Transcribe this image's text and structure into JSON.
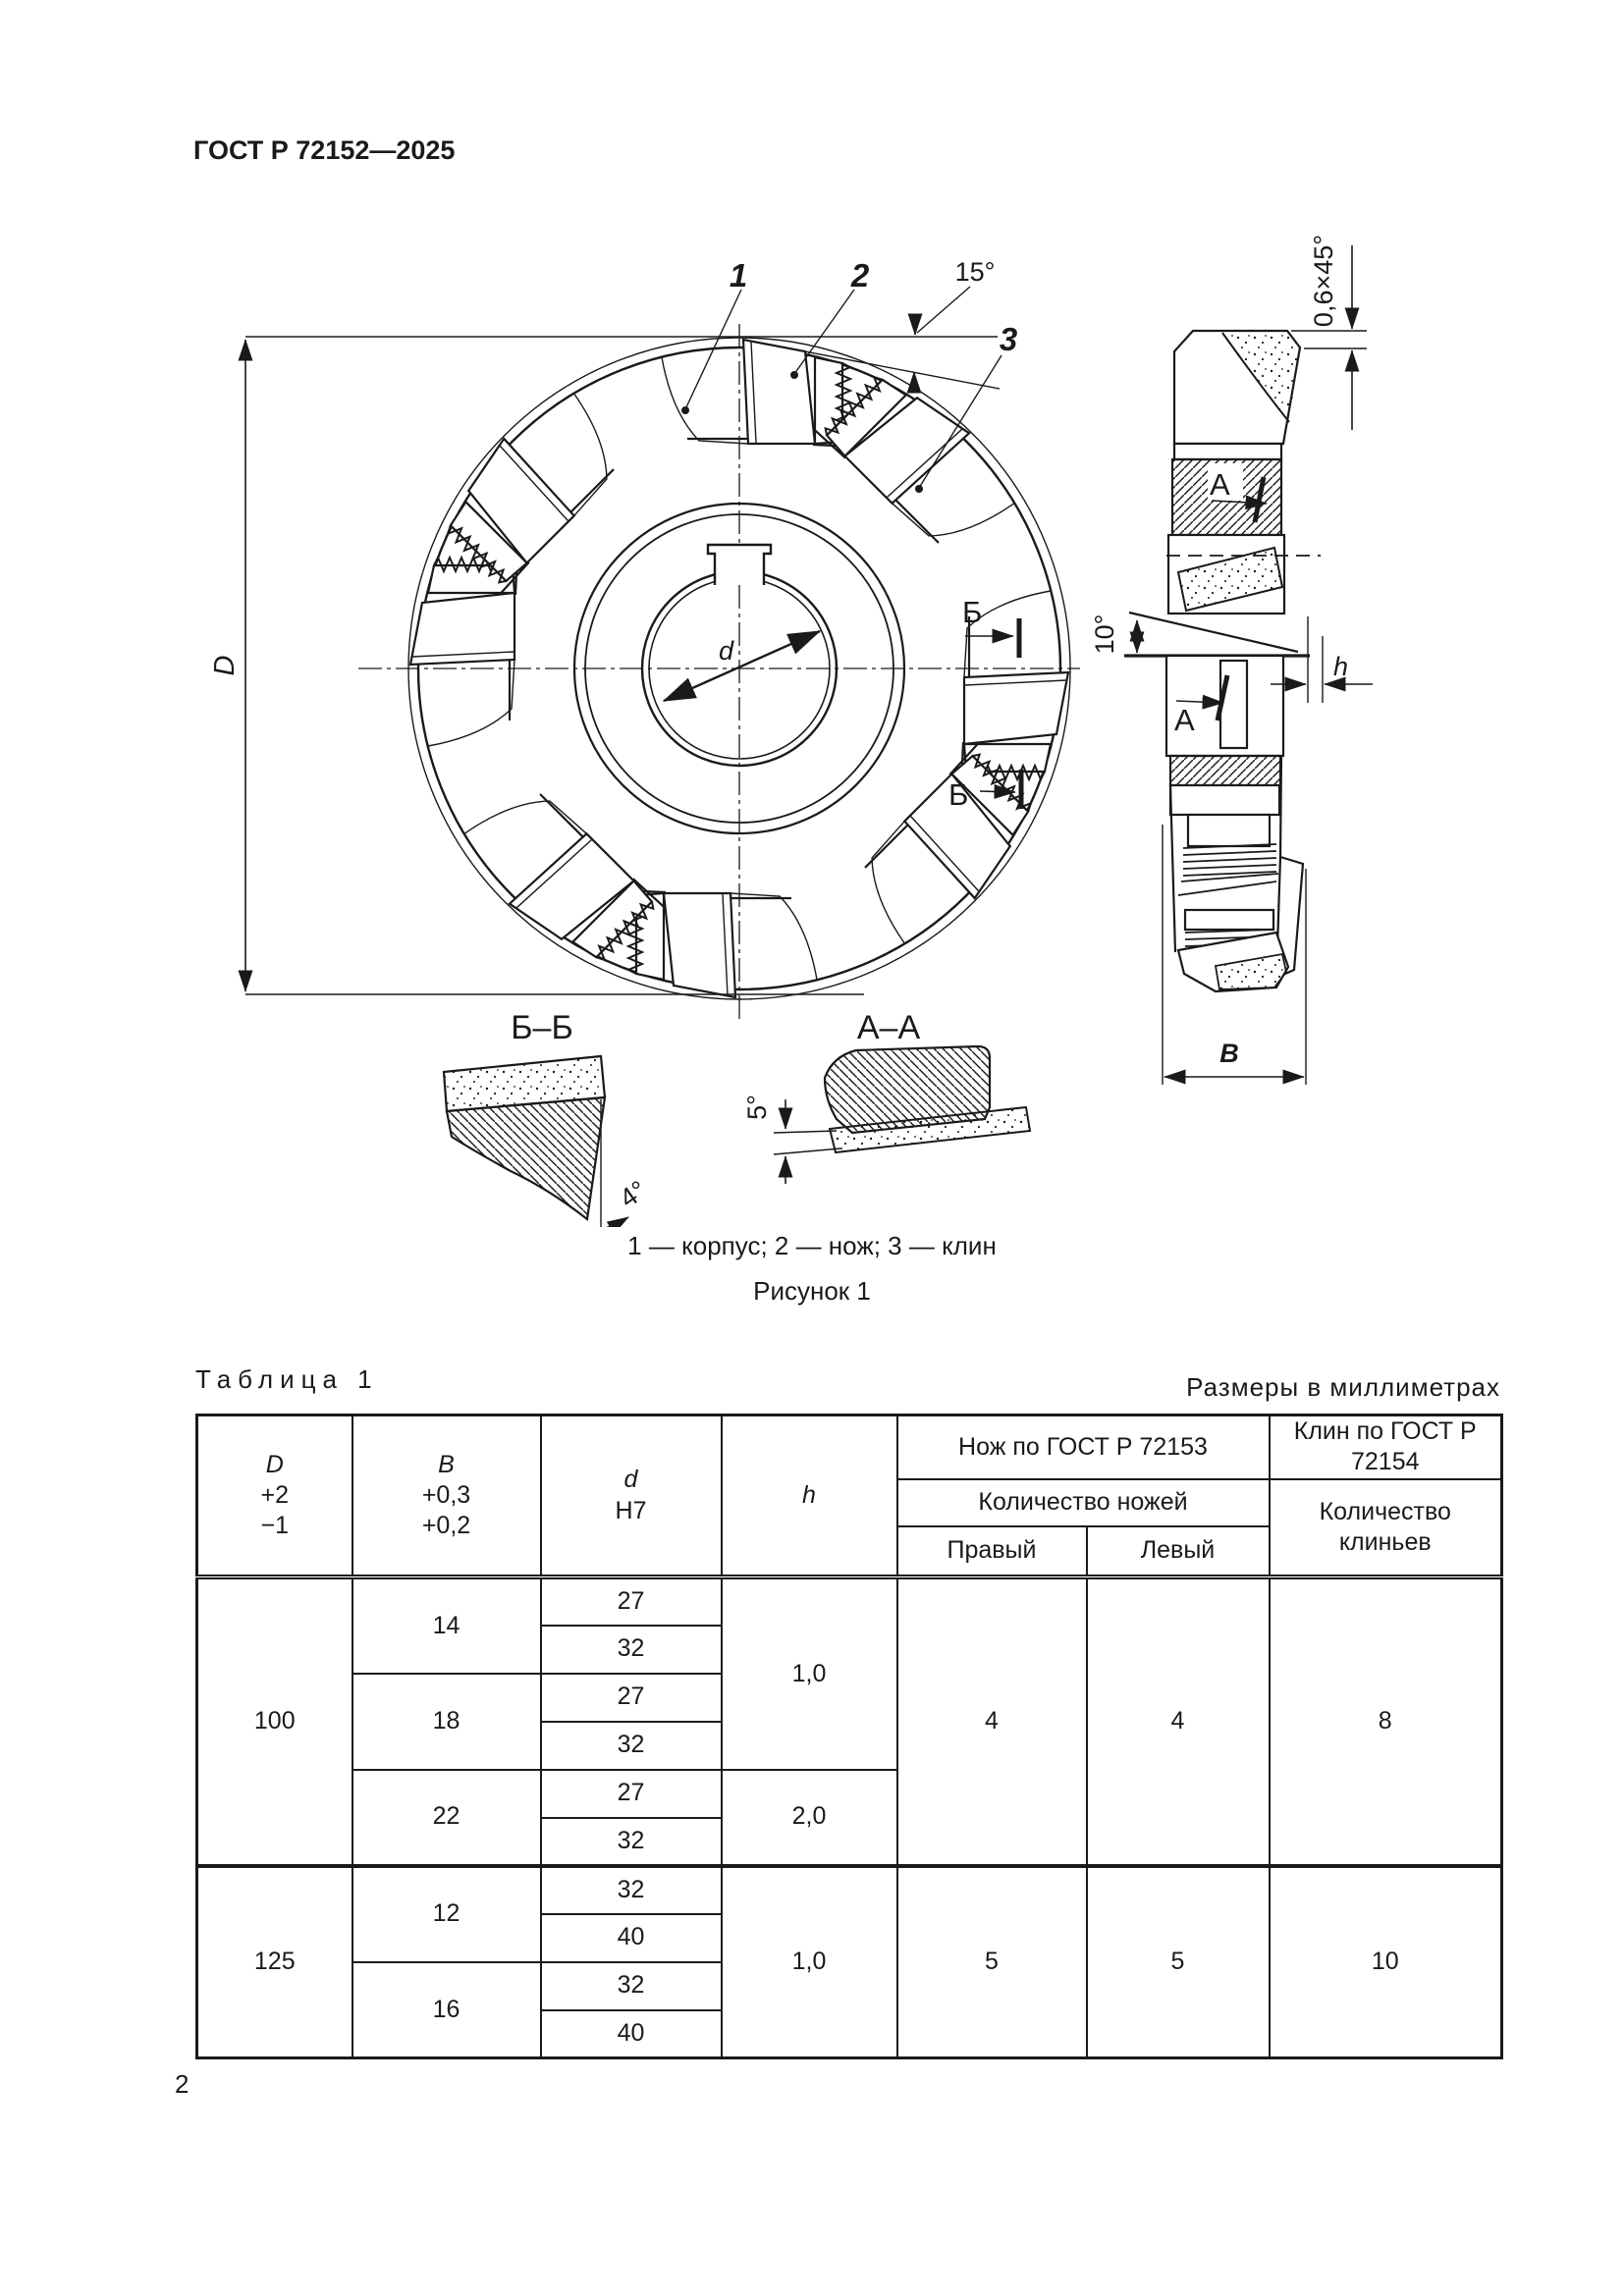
{
  "page": {
    "header": "ГОСТ Р 72152—2025",
    "page_number": "2"
  },
  "figure": {
    "caption": "1 — корпус; 2 — нож; 3 — клин",
    "label": "Рисунок 1",
    "section_bb": "Б–Б",
    "section_aa": "А–А",
    "ann": {
      "n1": "1",
      "n2": "2",
      "n3": "3",
      "a15": "15°",
      "a10": "10°",
      "a4": "4°",
      "a5": "5°",
      "chamfer": "0,6×45°",
      "D": "D",
      "d": "d",
      "B": "B",
      "h": "h",
      "b": "Б",
      "a": "А"
    }
  },
  "table": {
    "label": "Таблица 1",
    "units": "Размеры в миллиметрах",
    "header": {
      "D_sym": "D",
      "D_p": "+2",
      "D_m": "−1",
      "B_sym": "B",
      "B_p": "+0,3",
      "B_m": "+0,2",
      "d_sym": "d",
      "d_fit": "H7",
      "h_sym": "h",
      "knife_group": "Нож по ГОСТ Р 72153",
      "wedge_group": "Клин по ГОСТ Р 72154",
      "knife_count": "Количество ножей",
      "wedge_count": "Количество клиньев",
      "right": "Правый",
      "left": "Левый"
    },
    "body": {
      "g100": {
        "D": "100",
        "h12": "1,0",
        "h3": "2,0",
        "right": "4",
        "left": "4",
        "wedges": "8",
        "b14": {
          "B": "14",
          "d1": "27",
          "d2": "32"
        },
        "b18": {
          "B": "18",
          "d1": "27",
          "d2": "32"
        },
        "b22": {
          "B": "22",
          "d1": "27",
          "d2": "32"
        }
      },
      "g125": {
        "D": "125",
        "h": "1,0",
        "right": "5",
        "left": "5",
        "wedges": "10",
        "b12": {
          "B": "12",
          "d1": "32",
          "d2": "40"
        },
        "b16": {
          "B": "16",
          "d1": "32",
          "d2": "40"
        }
      }
    }
  }
}
